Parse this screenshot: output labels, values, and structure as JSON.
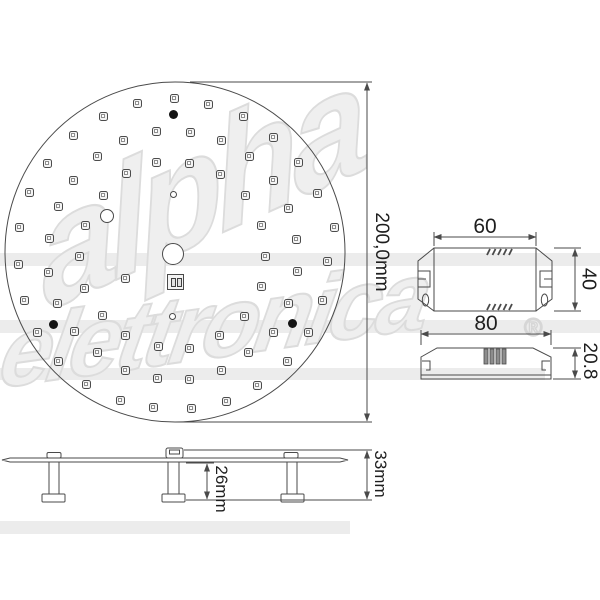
{
  "drawing_title": "LED module technical drawing",
  "labels": {
    "diameter": "200,0mm",
    "driver_width": "60",
    "driver_depth": "40",
    "driver_length": "80",
    "driver_height": "20.8",
    "spacer_height": "26mm",
    "overall_height": "33mm"
  },
  "watermark": {
    "word1": "alpha",
    "word2": "elettronica",
    "registered": "®"
  },
  "colors": {
    "line": "#4a4a4a",
    "text": "#1e1e1e",
    "watermark_stroke": "#dcdcdc",
    "led_border": "#4b4b4b",
    "dot_fill": "#141414"
  },
  "pcb": {
    "cx": 175,
    "cy": 252,
    "r": 170,
    "leds": [
      [
        137,
        103
      ],
      [
        174,
        98
      ],
      [
        103,
        116
      ],
      [
        73,
        135
      ],
      [
        123,
        140
      ],
      [
        156,
        131
      ],
      [
        97,
        156
      ],
      [
        156,
        162
      ],
      [
        47,
        163
      ],
      [
        126,
        173
      ],
      [
        73,
        180
      ],
      [
        29,
        192
      ],
      [
        103,
        195
      ],
      [
        58,
        206
      ],
      [
        85,
        225
      ],
      [
        19,
        227
      ],
      [
        49,
        238
      ],
      [
        208,
        104
      ],
      [
        243,
        116
      ],
      [
        190,
        132
      ],
      [
        221,
        140
      ],
      [
        273,
        137
      ],
      [
        249,
        156
      ],
      [
        189,
        163
      ],
      [
        298,
        162
      ],
      [
        220,
        174
      ],
      [
        273,
        180
      ],
      [
        245,
        195
      ],
      [
        317,
        193
      ],
      [
        288,
        208
      ],
      [
        261,
        225
      ],
      [
        334,
        227
      ],
      [
        296,
        239
      ],
      [
        18,
        264
      ],
      [
        48,
        272
      ],
      [
        79,
        256
      ],
      [
        125,
        278
      ],
      [
        84,
        288
      ],
      [
        24,
        300
      ],
      [
        57,
        303
      ],
      [
        102,
        315
      ],
      [
        37,
        332
      ],
      [
        74,
        331
      ],
      [
        125,
        335
      ],
      [
        158,
        346
      ],
      [
        97,
        352
      ],
      [
        58,
        361
      ],
      [
        125,
        370
      ],
      [
        157,
        378
      ],
      [
        86,
        384
      ],
      [
        120,
        400
      ],
      [
        153,
        407
      ],
      [
        265,
        256
      ],
      [
        327,
        261
      ],
      [
        297,
        271
      ],
      [
        261,
        286
      ],
      [
        288,
        303
      ],
      [
        322,
        300
      ],
      [
        244,
        316
      ],
      [
        273,
        332
      ],
      [
        308,
        332
      ],
      [
        219,
        335
      ],
      [
        189,
        348
      ],
      [
        248,
        352
      ],
      [
        287,
        361
      ],
      [
        221,
        370
      ],
      [
        189,
        379
      ],
      [
        257,
        385
      ],
      [
        226,
        401
      ],
      [
        191,
        408
      ]
    ],
    "dots": [
      [
        173,
        114
      ],
      [
        53,
        324
      ],
      [
        292,
        323
      ]
    ],
    "holes": [
      {
        "x": 173,
        "y": 254,
        "r": 11
      },
      {
        "x": 107,
        "y": 216,
        "r": 7
      },
      {
        "x": 173,
        "y": 194,
        "r": 3.5
      },
      {
        "x": 172,
        "y": 316,
        "r": 3.5
      }
    ],
    "connector": {
      "x": 167,
      "y": 274,
      "w": 17,
      "h": 16
    }
  }
}
